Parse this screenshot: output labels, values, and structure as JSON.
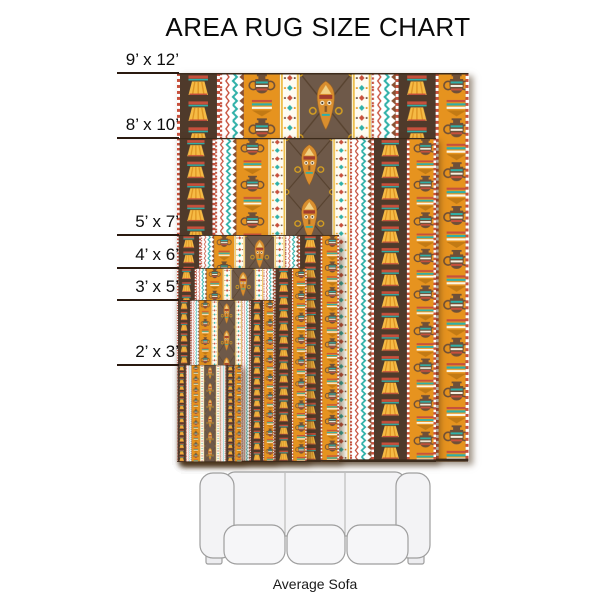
{
  "title": "AREA RUG SIZE CHART",
  "rugs": [
    {
      "label": "9’ x 12’",
      "width_ft": 9,
      "height_ft": 12
    },
    {
      "label": "8’ x 10’",
      "width_ft": 8,
      "height_ft": 10
    },
    {
      "label": "5’ x 7’",
      "width_ft": 5,
      "height_ft": 7
    },
    {
      "label": "4’ x 6’",
      "width_ft": 4,
      "height_ft": 6
    },
    {
      "label": "3’ x 5’",
      "width_ft": 3,
      "height_ft": 5
    },
    {
      "label": "2’ x 3’",
      "width_ft": 2,
      "height_ft": 3
    }
  ],
  "sofa": {
    "label": "Average Sofa"
  },
  "palette": {
    "rug_dark_brown": "#4f3a2b",
    "rug_taupe": "#6e5949",
    "rug_orange": "#e6931f",
    "rug_gold": "#f4b53f",
    "rug_teal": "#2fb0a8",
    "rug_red": "#c7503c",
    "rug_cream": "#fffcf2",
    "sofa_fill": "#f3f3f5",
    "sofa_stroke": "#9e9e9e"
  }
}
